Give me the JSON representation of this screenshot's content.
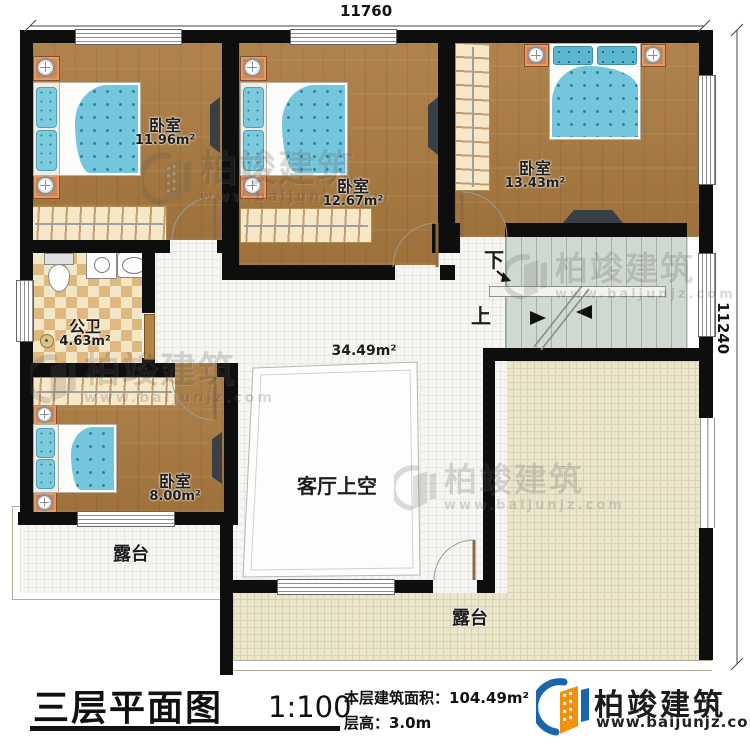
{
  "dimensions": {
    "top": "11760",
    "right": "11240"
  },
  "rooms": {
    "bedroom1": {
      "name": "卧室",
      "area": "11.96m²"
    },
    "bedroom2": {
      "name": "卧室",
      "area": "12.67m²"
    },
    "bedroom3": {
      "name": "卧室",
      "area": "13.43m²"
    },
    "bedroom4": {
      "name": "卧室",
      "area": "8.00m²"
    },
    "bathroom": {
      "name": "公卫",
      "area": "4.63m²"
    },
    "hall": {
      "area": "34.49m²"
    },
    "living_void": {
      "name": "客厅上空"
    },
    "terrace_left": {
      "name": "露台"
    },
    "terrace_right": {
      "name": "露台"
    }
  },
  "stairs": {
    "down": "下",
    "up": "上"
  },
  "footer": {
    "title": "三层平面图",
    "scale": "1:100",
    "area_line": "本层建筑面积：104.49m²",
    "height_line": "层高：3.0m"
  },
  "brand": {
    "name": "柏竣建筑",
    "url": "www.baijunjz.com"
  },
  "watermark": {
    "name": "柏竣建筑",
    "url": "www.baijunjz.com"
  }
}
